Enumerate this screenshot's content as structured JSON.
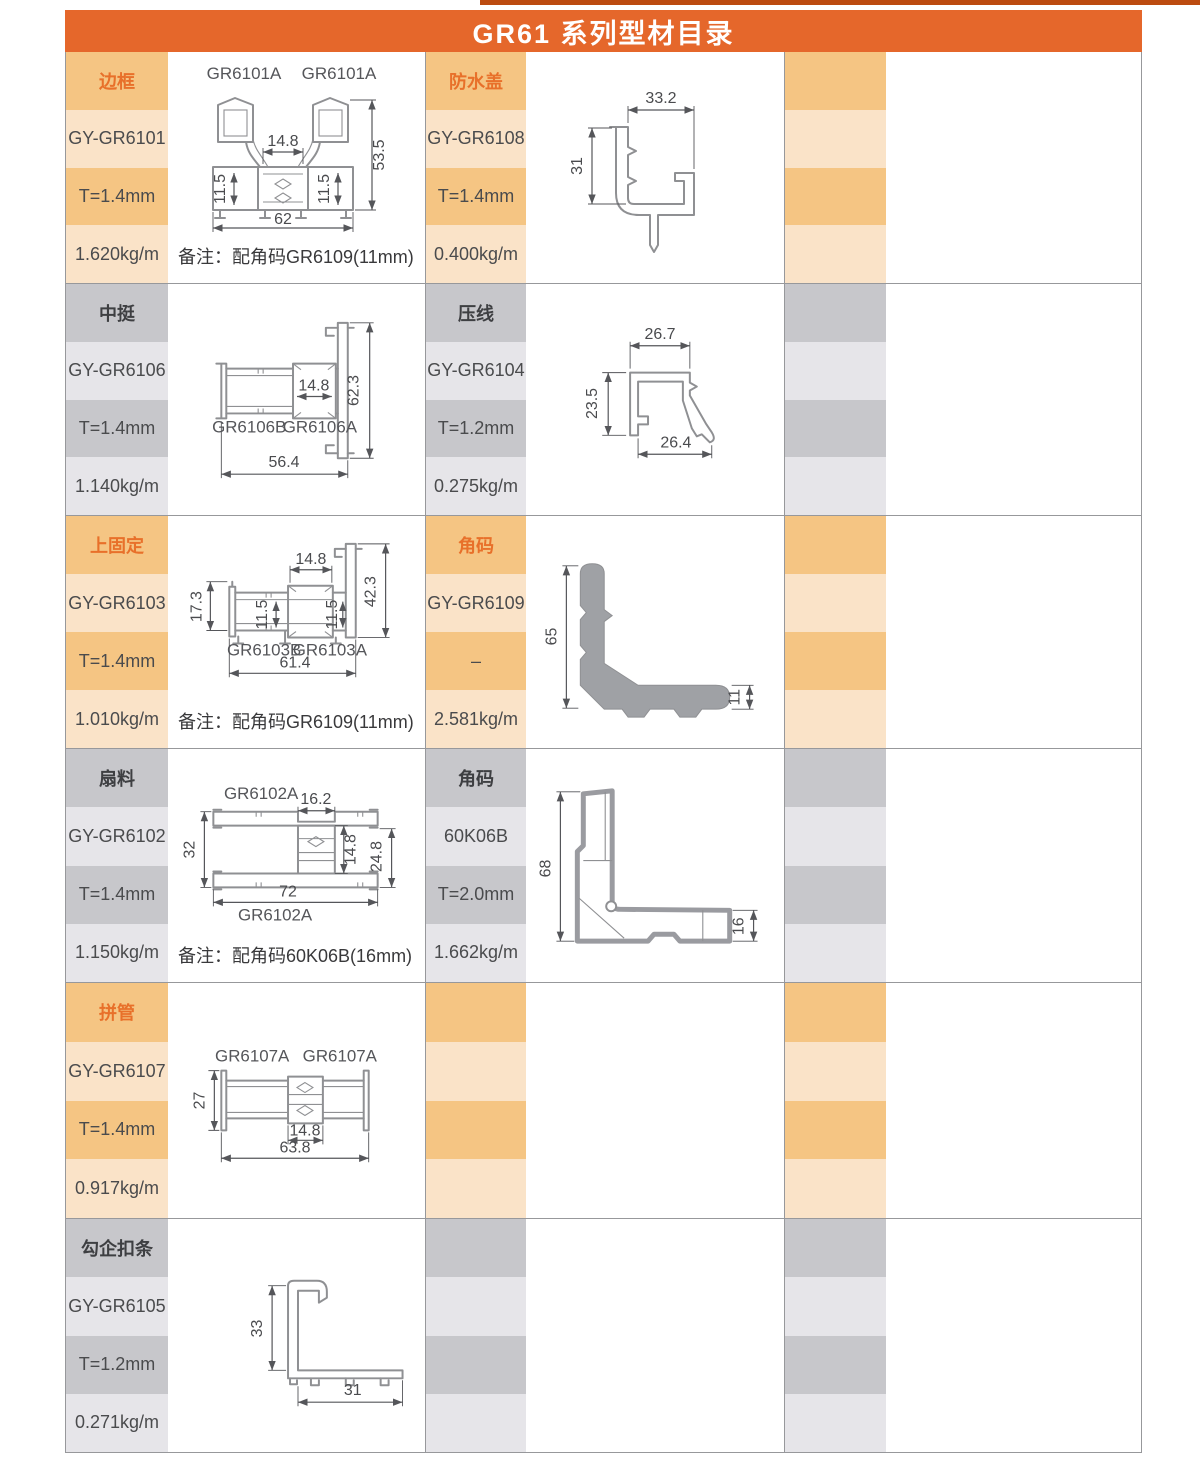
{
  "header": {
    "title": "GR61 系列型材目录"
  },
  "rows": [
    {
      "left": {
        "name": "边框",
        "code": "GY-GR6101",
        "thickness": "T=1.4mm",
        "weight": "1.620kg/m",
        "note": "备注：配角码GR6109(11mm)"
      },
      "leftDiag": {
        "label1": "GR6101A",
        "label2": "GR6101A",
        "dimMid": "14.8",
        "dimH": "53.5",
        "dimC1": "11.5",
        "dimC2": "11.5",
        "dimW": "62"
      },
      "mid": {
        "name": "防水盖",
        "code": "GY-GR6108",
        "thickness": "T=1.4mm",
        "weight": "0.400kg/m"
      },
      "midDiag": {
        "dimTop": "33.2",
        "dimLeft": "31"
      }
    },
    {
      "left": {
        "name": "中挺",
        "code": "GY-GR6106",
        "thickness": "T=1.4mm",
        "weight": "1.140kg/m"
      },
      "leftDiag": {
        "label1": "GR6106B",
        "label2": "GR6106A",
        "dimMid": "14.8",
        "dimH": "62.3",
        "dimW": "56.4"
      },
      "mid": {
        "name": "压线",
        "code": "GY-GR6104",
        "thickness": "T=1.2mm",
        "weight": "0.275kg/m"
      },
      "midDiag": {
        "dimTop": "26.7",
        "dimLeft": "23.5",
        "dimBottom": "26.4"
      }
    },
    {
      "left": {
        "name": "上固定",
        "code": "GY-GR6103",
        "thickness": "T=1.4mm",
        "weight": "1.010kg/m",
        "note": "备注：配角码GR6109(11mm)"
      },
      "leftDiag": {
        "label1": "GR6103B",
        "label2": "GR6103A",
        "dimMid": "14.8",
        "dimH": "42.3",
        "dimL": "17.3",
        "dimC1": "11.5",
        "dimC2": "11.5",
        "dimW": "61.4"
      },
      "mid": {
        "name": "角码",
        "code": "GY-GR6109",
        "thickness": "–",
        "weight": "2.581kg/m"
      },
      "midDiag": {
        "dimLeft": "65",
        "dimRight": "11"
      }
    },
    {
      "left": {
        "name": "扇料",
        "code": "GY-GR6102",
        "thickness": "T=1.4mm",
        "weight": "1.150kg/m",
        "note": "备注：配角码60K06B(16mm)"
      },
      "leftDiag": {
        "labelTop": "GR6102A",
        "labelBottom": "GR6102A",
        "dimTop": "16.2",
        "dimL": "32",
        "dimMid": "14.8",
        "dimR": "24.8",
        "dimW": "72"
      },
      "mid": {
        "name": "角码",
        "code": "60K06B",
        "thickness": "T=2.0mm",
        "weight": "1.662kg/m"
      },
      "midDiag": {
        "dimLeft": "68",
        "dimRight": "16"
      }
    },
    {
      "left": {
        "name": "拼管",
        "code": "GY-GR6107",
        "thickness": "T=1.4mm",
        "weight": "0.917kg/m"
      },
      "leftDiag": {
        "label1": "GR6107A",
        "label2": "GR6107A",
        "dimL": "27",
        "dimMid": "14.8",
        "dimW": "63.8"
      }
    },
    {
      "left": {
        "name": "勾企扣条",
        "code": "GY-GR6105",
        "thickness": "T=1.2mm",
        "weight": "0.271kg/m"
      },
      "leftDiag": {
        "dimL": "33",
        "dimW": "31"
      }
    }
  ]
}
